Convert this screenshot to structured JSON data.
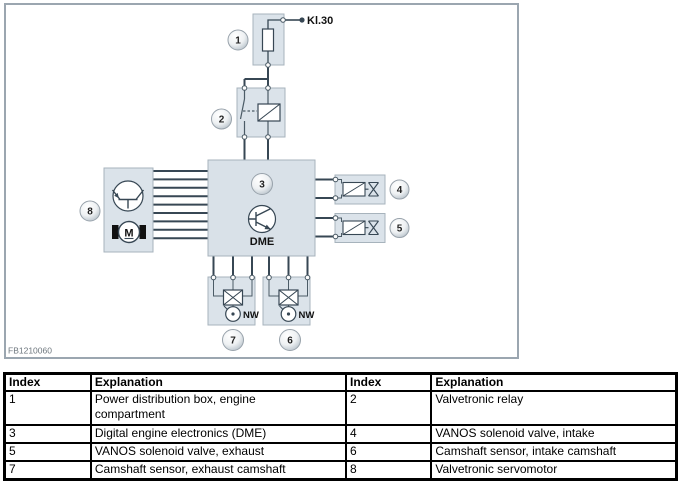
{
  "diagram": {
    "figure_id": "FB1210060",
    "terminal_label": "Kl.30",
    "dme_label": "DME",
    "nw_label": "NW",
    "motor_label": "M",
    "callouts": {
      "c1": "1",
      "c2": "2",
      "c3": "3",
      "c4": "4",
      "c5": "5",
      "c6": "6",
      "c7": "7",
      "c8": "8"
    },
    "colors": {
      "frame_border": "#9ba6b0",
      "component_box_fill": "#dbe3ea",
      "component_box_border": "#a7b3bc",
      "wire": "#374754",
      "figure_id_text": "#6d767d"
    }
  },
  "legend_table": {
    "header_index": "Index",
    "header_explanation": "Explanation",
    "rows": [
      {
        "i1": "1",
        "e1": "Power distribution box, engine\ncompartment",
        "i2": "2",
        "e2": "Valvetronic relay"
      },
      {
        "i1": "3",
        "e1": "Digital engine electronics (DME)",
        "i2": "4",
        "e2": "VANOS solenoid valve, intake"
      },
      {
        "i1": "5",
        "e1": "VANOS solenoid valve, exhaust",
        "i2": "6",
        "e2": "Camshaft sensor, intake camshaft"
      },
      {
        "i1": "7",
        "e1": "Camshaft sensor, exhaust camshaft",
        "i2": "8",
        "e2": "Valvetronic servomotor"
      }
    ]
  }
}
